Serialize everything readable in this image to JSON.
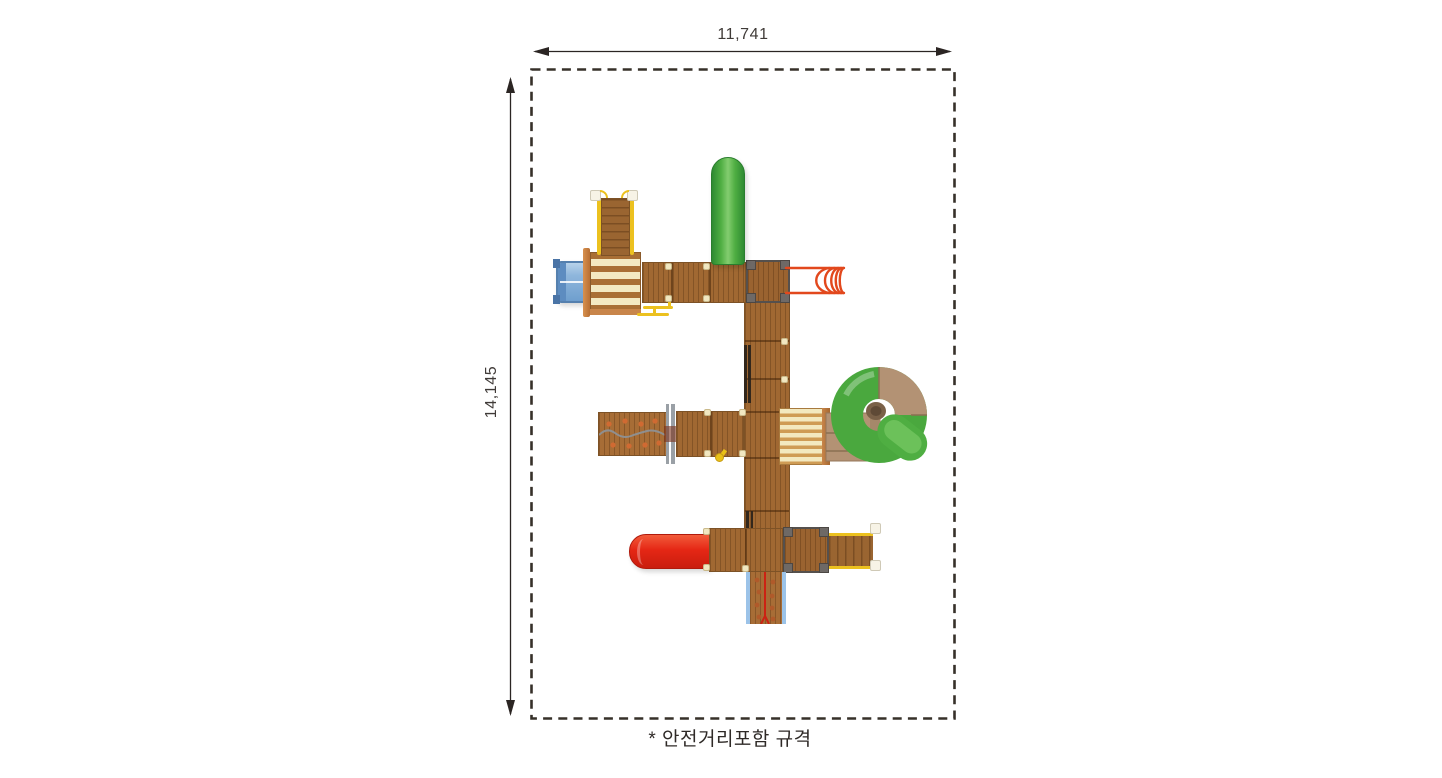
{
  "labels": {
    "width": "11,741",
    "height": "14,145",
    "footnote": "* 안전거리포함 규격"
  },
  "colors": {
    "background": "#ffffff",
    "annotation_line": "#2b2523",
    "text": "#3a3533",
    "boundary_dash": "#363029",
    "wood": "#a06832",
    "wood_dark": "#7d5226",
    "roof_cream_stripe": "#f3e9c2",
    "roof_brown_stripe": "#a96f35",
    "deck_cream_stripe": "#f3e9c0",
    "deck_tan_stripe": "#cf9c55",
    "slide_green": "#4aa83e",
    "slide_red": "#e52715",
    "crawl_tube_blue": "#8fb6dc",
    "spiral_tube_tan": "#b39274",
    "handrail_yellow": "#ecc11f",
    "arch_ladder_orange": "#e2481d",
    "climb_wall_rail_blue": "#9cc3e8",
    "corner_frame_dark": "#55504d"
  },
  "parts": [
    "safety-boundary",
    "width-dimension",
    "height-dimension",
    "entry-stairs-top",
    "striped-roof",
    "blue-crawl-tube",
    "green-tube-slide",
    "orange-arch-ladder",
    "platform-row-top",
    "platform-column",
    "climbing-ramp",
    "striped-deck",
    "spiral-tube-slide",
    "red-slide",
    "platform-row-bottom",
    "exit-stairs-right",
    "climbing-wall-bottom"
  ]
}
